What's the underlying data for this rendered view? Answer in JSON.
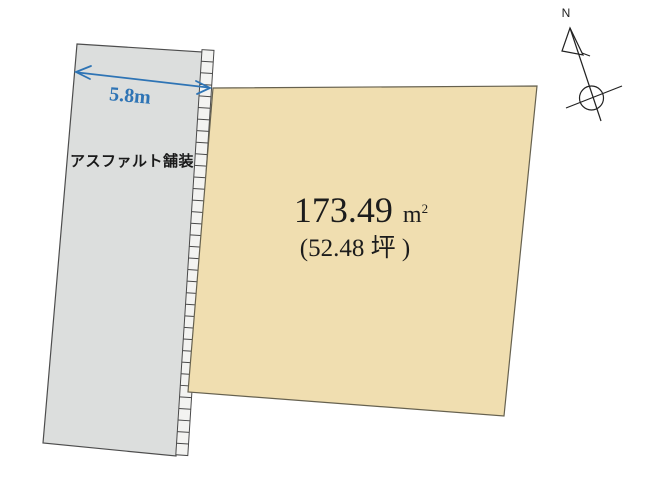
{
  "road": {
    "surface_label": "アスファルト舗装",
    "width_label": "5.8m"
  },
  "plot": {
    "area_value": "173.49",
    "area_unit_base": "m",
    "area_unit_exponent": "2",
    "tsubo_label": "(52.48 坪 )"
  },
  "compass": {
    "north_label": "N"
  },
  "colors": {
    "road_fill": "#dcdedd",
    "plot_fill": "#f0deb0",
    "boundary_strip_fill": "#f3f3f1",
    "dimension_blue": "#2e74b5",
    "compass_stroke": "#222222"
  }
}
